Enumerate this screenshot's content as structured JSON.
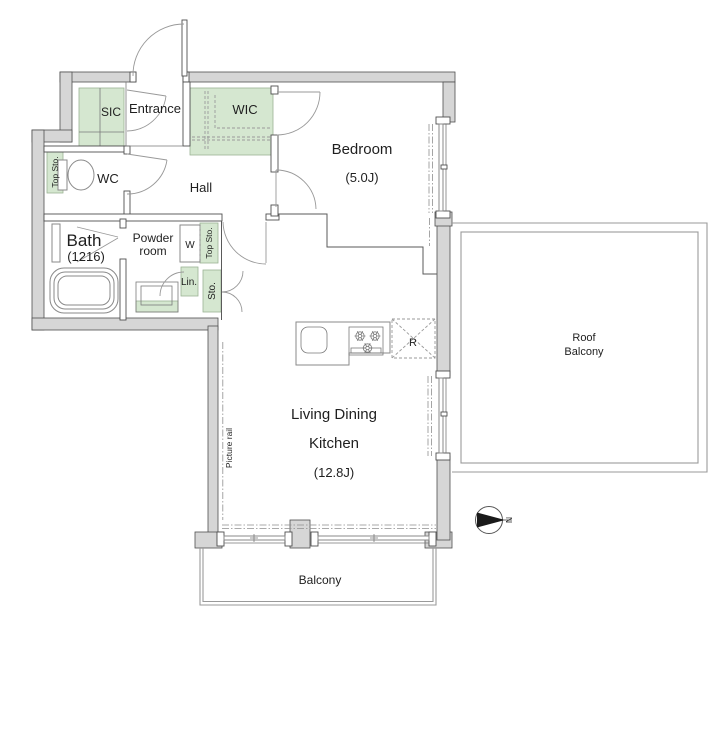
{
  "colors": {
    "wall_fill": "#d6d6d6",
    "wall_outline": "#4f4f4f",
    "storage_fill": "#d5e7d0",
    "storage_outline": "#9bb394",
    "text": "#1f1f1f",
    "compass_fill": "#1a1a1a"
  },
  "rooms": {
    "entrance": {
      "label": "Entrance"
    },
    "sic": {
      "label": "SIC"
    },
    "wic": {
      "label": "WIC"
    },
    "wc": {
      "label": "WC"
    },
    "hall": {
      "label": "Hall"
    },
    "bath": {
      "label": "Bath",
      "size": "(1216)"
    },
    "powder_room": {
      "line1": "Powder",
      "line2": "room"
    },
    "bedroom": {
      "label": "Bedroom",
      "area": "(5.0J)"
    },
    "living_dining_kitchen": {
      "line1": "Living Dining",
      "line2": "Kitchen",
      "area": "(12.8J)"
    },
    "balcony": {
      "label": "Balcony"
    },
    "roof_balcony": {
      "line1": "Roof",
      "line2": "Balcony"
    }
  },
  "storage": {
    "top_storage_wc": {
      "label": "Top Sto."
    },
    "top_storage_powder": {
      "label": "Top Sto."
    },
    "linen": {
      "label": "Lin."
    },
    "storage_closet": {
      "label": "Sto."
    },
    "washer": {
      "label": "W"
    },
    "refrigerator": {
      "label": "R"
    }
  },
  "annotations": {
    "picture_rail": {
      "label": "Picture rail"
    },
    "compass": {
      "north": "N"
    }
  }
}
